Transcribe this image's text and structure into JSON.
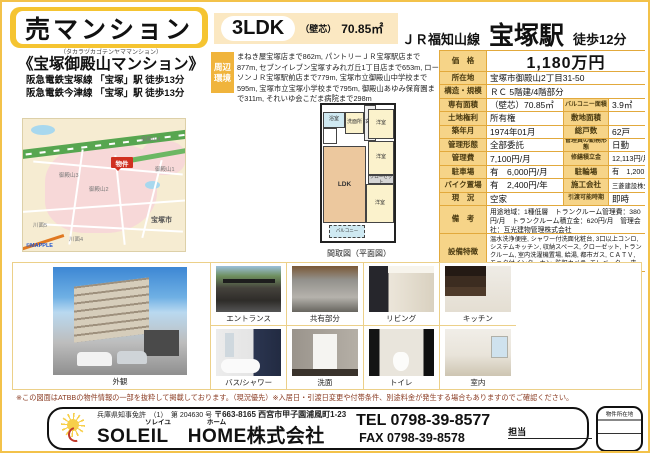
{
  "colors": {
    "accent": "#f5c431",
    "table_border": "#e2a93c",
    "label_bg": "#f6d488",
    "marker_red": "#d03020"
  },
  "header": {
    "type_label": "売マンション",
    "layout": "3LDK",
    "area_prefix": "（壁芯）",
    "area": "70.85㎡",
    "line": "ＪＲ福知山線",
    "station": "宝塚駅",
    "walk": "徒歩12分"
  },
  "property": {
    "furigana": "（タカラヅカゴテンヤママンション）",
    "name": "《宝塚御殿山マンション》",
    "access1": "阪急電鉄宝塚線 「宝塚」駅 徒歩13分",
    "access2": "阪急電鉄今津線 「宝塚」駅 徒歩13分"
  },
  "environment": {
    "label": "周辺環境",
    "text": "まねき屋宝塚店まで862m, パントリーＪＲ宝塚駅店まで877m, セブンイレブン宝塚すみれガ丘1丁目店まで653m, ローソンＪＲ宝塚駅前店まで779m, 宝塚市立御殿山中学校まで595m, 宝塚市立宝塚小学校まで795m, 御殿山あゆみ保育園まで311m, それいゆ会こだま病院まで298m"
  },
  "details": {
    "price": {
      "label": "価　格",
      "value": "1,180万円"
    },
    "location": {
      "label": "所在地",
      "value": "宝塚市御殿山2丁目31-50"
    },
    "structure": {
      "label": "構造・規模",
      "value": "ＲＣ 5階建/4階部分"
    },
    "area": {
      "label": "専有面積",
      "value": "（壁芯）70.85㎡"
    },
    "balcony": {
      "label": "バルコニー面積",
      "value": "3.9㎡"
    },
    "land_right": {
      "label": "土地権利",
      "value": "所有権"
    },
    "site_area": {
      "label": "敷地面積",
      "value": ""
    },
    "built": {
      "label": "築年月",
      "value": "1974年01月"
    },
    "units": {
      "label": "総戸数",
      "value": "62戸"
    },
    "mgmt_type": {
      "label": "管理形態",
      "value": "全部委託"
    },
    "mgr_duty": {
      "label": "管理員の勤務形態",
      "value": "日勤"
    },
    "mgmt_fee": {
      "label": "管理費",
      "value": "7,100円/月"
    },
    "repair_fund": {
      "label": "修繕積立金",
      "value": "12,113円/月"
    },
    "parking": {
      "label": "駐車場",
      "value": "有　6,000円/月"
    },
    "bicycle": {
      "label": "駐輪場",
      "value": "有　1,200円/年"
    },
    "bike": {
      "label": "バイク置場",
      "value": "有　2,400円/年"
    },
    "builder": {
      "label": "施工会社",
      "value": "三菱建設株式会社"
    },
    "status": {
      "label": "現　況",
      "value": "空家"
    },
    "handover": {
      "label": "引渡可能時期",
      "value": "即時"
    },
    "remarks": {
      "label": "備　考",
      "value": "用途地域：1種低層　トランクルーム管理費：380円/月　トランクルーム積立金：620円/月　管理会社：互光建物管理株式会社"
    },
    "features": {
      "label": "設備特徴",
      "value": "温水洗浄便座, シャワー付洗面化粧台, 3口以上コンロ, システムキッチン, 収納スペース, クローゼット, トランクルーム, 室内洗濯機置場, 給湯, 都市ガス, ＣＡＴＶ, モニタ付インターホン, 防犯カメラ, エレベーター, 来客用駐車場, 主要採光面：南向き, 閑静な住宅街"
    }
  },
  "map": {
    "marker": "物件",
    "labels": [
      "御殿山4",
      "御殿山3",
      "御殿山2",
      "御殿山1",
      "宝塚市",
      "川面5",
      "川面4"
    ],
    "credit": "©MAPPLE"
  },
  "floorplan": {
    "caption": "間取図（平面図）",
    "rooms": {
      "ldk": "LDK",
      "western": "洋室",
      "closet": "クローゼット",
      "balcony": "バルコニー",
      "bath": "浴室",
      "wash": "洗面所",
      "entrance": "玄関"
    }
  },
  "photos": {
    "exterior": {
      "caption": "外観"
    },
    "grid": [
      {
        "caption": "エントランス"
      },
      {
        "caption": "共有部分"
      },
      {
        "caption": "リビング"
      },
      {
        "caption": "キッチン"
      },
      {
        "caption": "バス/シャワー"
      },
      {
        "caption": "洗面"
      },
      {
        "caption": "トイレ"
      },
      {
        "caption": "室内"
      }
    ]
  },
  "footnote": "※この図面はATBBの物件情報の一部を抜粋して掲載しております。（現況優先）※入居日・引渡日変更や付帯条件、別途料金が発生する場合もありますのでご確認ください。",
  "footer": {
    "license": "兵庫県知事免許　（1）　第 204630 号",
    "address": "〒663-8165 西宮市甲子園浦風町1-23",
    "furigana1": "ソレイユ",
    "furigana2": "ホーム",
    "company": "SOLEIL　HOME株式会社",
    "tel": "TEL 0798-39-8577",
    "fax": "FAX 0798-39-8578",
    "staff_label": "担当",
    "stamp_label": "物件所在地"
  }
}
